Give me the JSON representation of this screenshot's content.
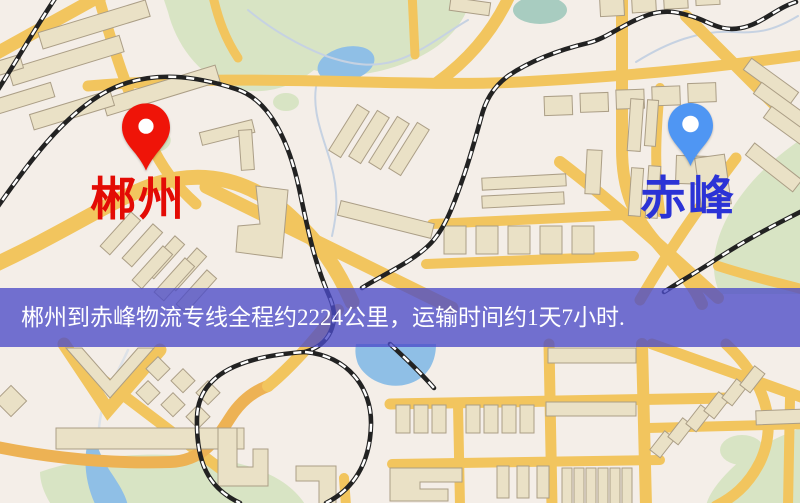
{
  "banner": {
    "text": "郴州到赤峰物流专线全程约2224公里，运输时间约1天7小时.",
    "background_color": "#4b4bc8",
    "text_color": "#ffffff"
  },
  "markers": {
    "origin": {
      "name": "郴州",
      "pin_color": "#ef1408",
      "label_color": "#e30b05"
    },
    "destination": {
      "name": "赤峰",
      "pin_color": "#4f96f3",
      "label_color": "#2b33d6"
    }
  },
  "route": {
    "distance_text": "约2224公里",
    "duration_text": "约1天7小时"
  }
}
